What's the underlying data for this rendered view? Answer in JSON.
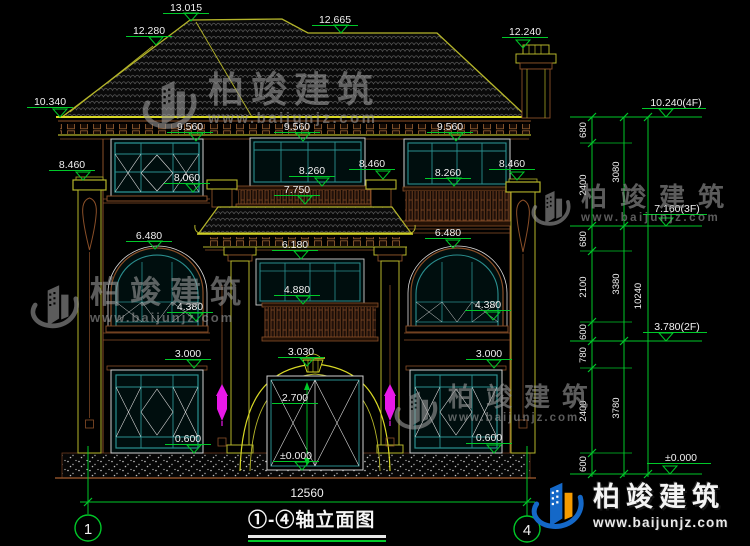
{
  "title_block": {
    "title": "①-④轴立面图"
  },
  "axes": {
    "left": "1",
    "right": "4"
  },
  "overall_dim": "12560",
  "watermark": {
    "name": "柏竣建筑",
    "url": "www.baijunjz.com"
  },
  "markers": [
    {
      "t": "13.015",
      "x": 186,
      "y": 11,
      "ax": 191,
      "ay": 21
    },
    {
      "t": "12.280",
      "x": 149,
      "y": 34,
      "ax": 156,
      "ay": 45
    },
    {
      "t": "12.665",
      "x": 335,
      "y": 23,
      "ax": 341,
      "ay": 33
    },
    {
      "t": "12.240",
      "x": 525,
      "y": 35,
      "ax": 523,
      "ay": 48
    },
    {
      "t": "10.340",
      "x": 50,
      "y": 105,
      "ax": 60,
      "ay": 117
    },
    {
      "t": "8.460",
      "x": 72,
      "y": 168,
      "ax": 83,
      "ay": 180
    },
    {
      "t": "9.560",
      "x": 190,
      "y": 130,
      "ax": 196,
      "ay": 141
    },
    {
      "t": "9.560",
      "x": 297,
      "y": 130,
      "ax": 303,
      "ay": 141
    },
    {
      "t": "9.560",
      "x": 450,
      "y": 130,
      "ax": 456,
      "ay": 141
    },
    {
      "t": "8.060",
      "x": 187,
      "y": 181,
      "ax": 193,
      "ay": 192
    },
    {
      "t": "8.260",
      "x": 312,
      "y": 174,
      "ax": 322,
      "ay": 186
    },
    {
      "t": "8.260",
      "x": 448,
      "y": 176,
      "ax": 454,
      "ay": 186
    },
    {
      "t": "8.460",
      "x": 372,
      "y": 167,
      "ax": 383,
      "ay": 179
    },
    {
      "t": "8.460",
      "x": 512,
      "y": 167,
      "ax": 517,
      "ay": 180
    },
    {
      "t": "7.750",
      "x": 297,
      "y": 193,
      "ax": 305,
      "ay": 204
    },
    {
      "t": "6.480",
      "x": 149,
      "y": 239,
      "ax": 155,
      "ay": 249
    },
    {
      "t": "6.480",
      "x": 448,
      "y": 236,
      "ax": 453,
      "ay": 248
    },
    {
      "t": "6.180",
      "x": 295,
      "y": 248,
      "ax": 301,
      "ay": 259
    },
    {
      "t": "4.880",
      "x": 297,
      "y": 293,
      "ax": 303,
      "ay": 304
    },
    {
      "t": "4.380",
      "x": 190,
      "y": 310,
      "ax": 196,
      "ay": 321
    },
    {
      "t": "4.380",
      "x": 488,
      "y": 308,
      "ax": 493,
      "ay": 320
    },
    {
      "t": "3.000",
      "x": 188,
      "y": 357,
      "ax": 194,
      "ay": 368
    },
    {
      "t": "3.030",
      "x": 301,
      "y": 355,
      "ax": 307,
      "ay": 366
    },
    {
      "t": "3.000",
      "x": 489,
      "y": 357,
      "ax": 494,
      "ay": 368
    },
    {
      "t": "2.700",
      "x": 295,
      "y": 401
    },
    {
      "t": "±0.000",
      "x": 296,
      "y": 459,
      "ax": 302,
      "ay": 470
    },
    {
      "t": "0.600",
      "x": 188,
      "y": 442,
      "ax": 194,
      "ay": 453
    },
    {
      "t": "0.600",
      "x": 489,
      "y": 441,
      "ax": 494,
      "ay": 453
    }
  ],
  "right_levels": [
    {
      "t": "10.240(4F)",
      "x": 676,
      "y": 106,
      "ax": 666,
      "ay": 117
    },
    {
      "t": "7.160(3F)",
      "x": 677,
      "y": 212,
      "ax": 666,
      "ay": 226
    },
    {
      "t": "3.780(2F)",
      "x": 677,
      "y": 330,
      "ax": 666,
      "ay": 341
    },
    {
      "t": "±0.000",
      "x": 681,
      "y": 461,
      "ax": 670,
      "ay": 474
    }
  ],
  "chain_labels": [
    {
      "t": "680",
      "x": 586,
      "y": 130
    },
    {
      "t": "2400",
      "x": 586,
      "y": 185
    },
    {
      "t": "680",
      "x": 586,
      "y": 239
    },
    {
      "t": "2100",
      "x": 586,
      "y": 287
    },
    {
      "t": "600",
      "x": 586,
      "y": 332
    },
    {
      "t": "780",
      "x": 586,
      "y": 355
    },
    {
      "t": "2400",
      "x": 586,
      "y": 411
    },
    {
      "t": "600",
      "x": 586,
      "y": 464
    },
    {
      "t": "3080",
      "x": 619,
      "y": 172
    },
    {
      "t": "3380",
      "x": 619,
      "y": 284
    },
    {
      "t": "3780",
      "x": 619,
      "y": 408
    },
    {
      "t": "10240",
      "x": 641,
      "y": 296
    }
  ],
  "colors": {
    "dim_green": "#00c829",
    "line_yellow": "#b5b52a",
    "line_brown": "#8a4f28",
    "frame_teal": "#2a8f8f",
    "lamp_magenta": "#e818e8",
    "logo_blue": "#1468c8",
    "logo_orange": "#f59b00"
  }
}
